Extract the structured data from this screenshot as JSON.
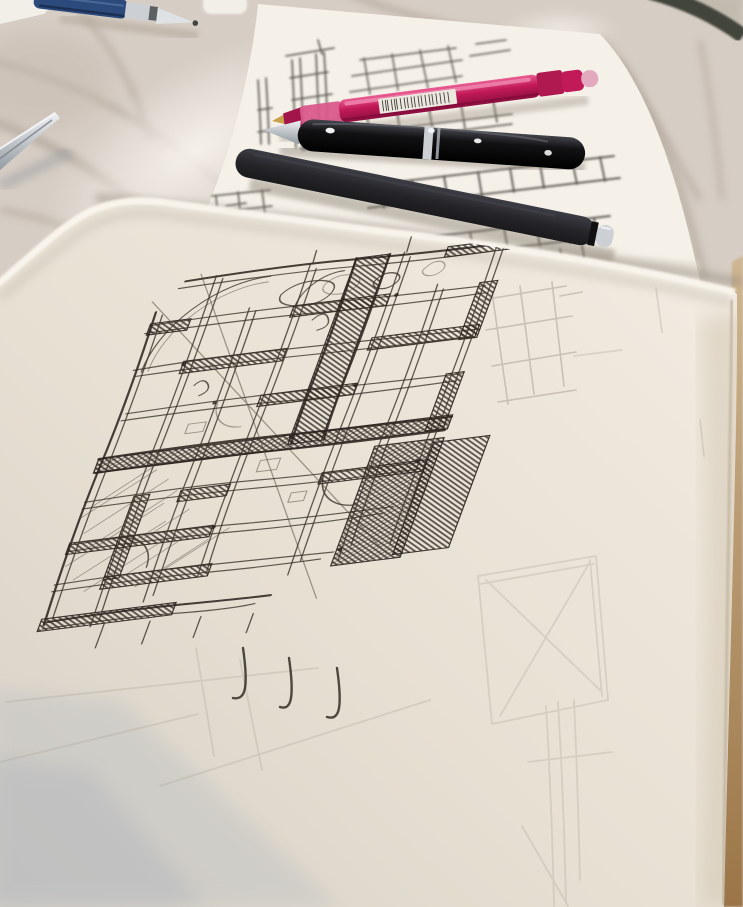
{
  "scene": {
    "title": "Hand-drawn architectural floor plan sketches in ink on sketchbook pages, with pens lying on a marble table",
    "setting": "round marble table photographed at an angle; dark table edge visible at the top-right corner",
    "objects": [
      {
        "id": "foreground-page",
        "label": "large sketchbook page with a dense ink floor-plan sketch, pencil ghost lines and a curled bright top edge"
      },
      {
        "id": "back-sheet",
        "label": "second sketch sheet behind, with smaller ink studies partly covered by pens"
      },
      {
        "id": "pink-pen",
        "label": "translucent pink gel pen with a white barcode sticker"
      },
      {
        "id": "glossy-pen",
        "label": "glossy black cigar-shaped fountain pen with silver cap band"
      },
      {
        "id": "matte-pen",
        "label": "matte black rollerball pen with silver tip"
      },
      {
        "id": "blue-pen",
        "label": "navy mechanical pencil with metal tip at the top edge"
      },
      {
        "id": "metal-tool",
        "label": "thin metal tool entering from the left edge"
      },
      {
        "id": "paper-scrap",
        "label": "small white paper scraps at the top edge"
      }
    ]
  },
  "colors": {
    "marble": "#d6cdc4",
    "sheet": "#f5f1e9",
    "scrap": "#f2efe8",
    "label": "#ece8df",
    "pink_body": "#c21a58",
    "pink_nub": "#e2a9bf",
    "gloss_black": "#0e0e11",
    "matte_black": "#28282c",
    "silver": "#ccd0d5",
    "navy": "#2c4a7c",
    "ink": "#352f26",
    "pencil": "#a49b8d",
    "page": "#e9e2d5",
    "tan_edge": "#b08a58",
    "table_edge": "#42443a"
  }
}
